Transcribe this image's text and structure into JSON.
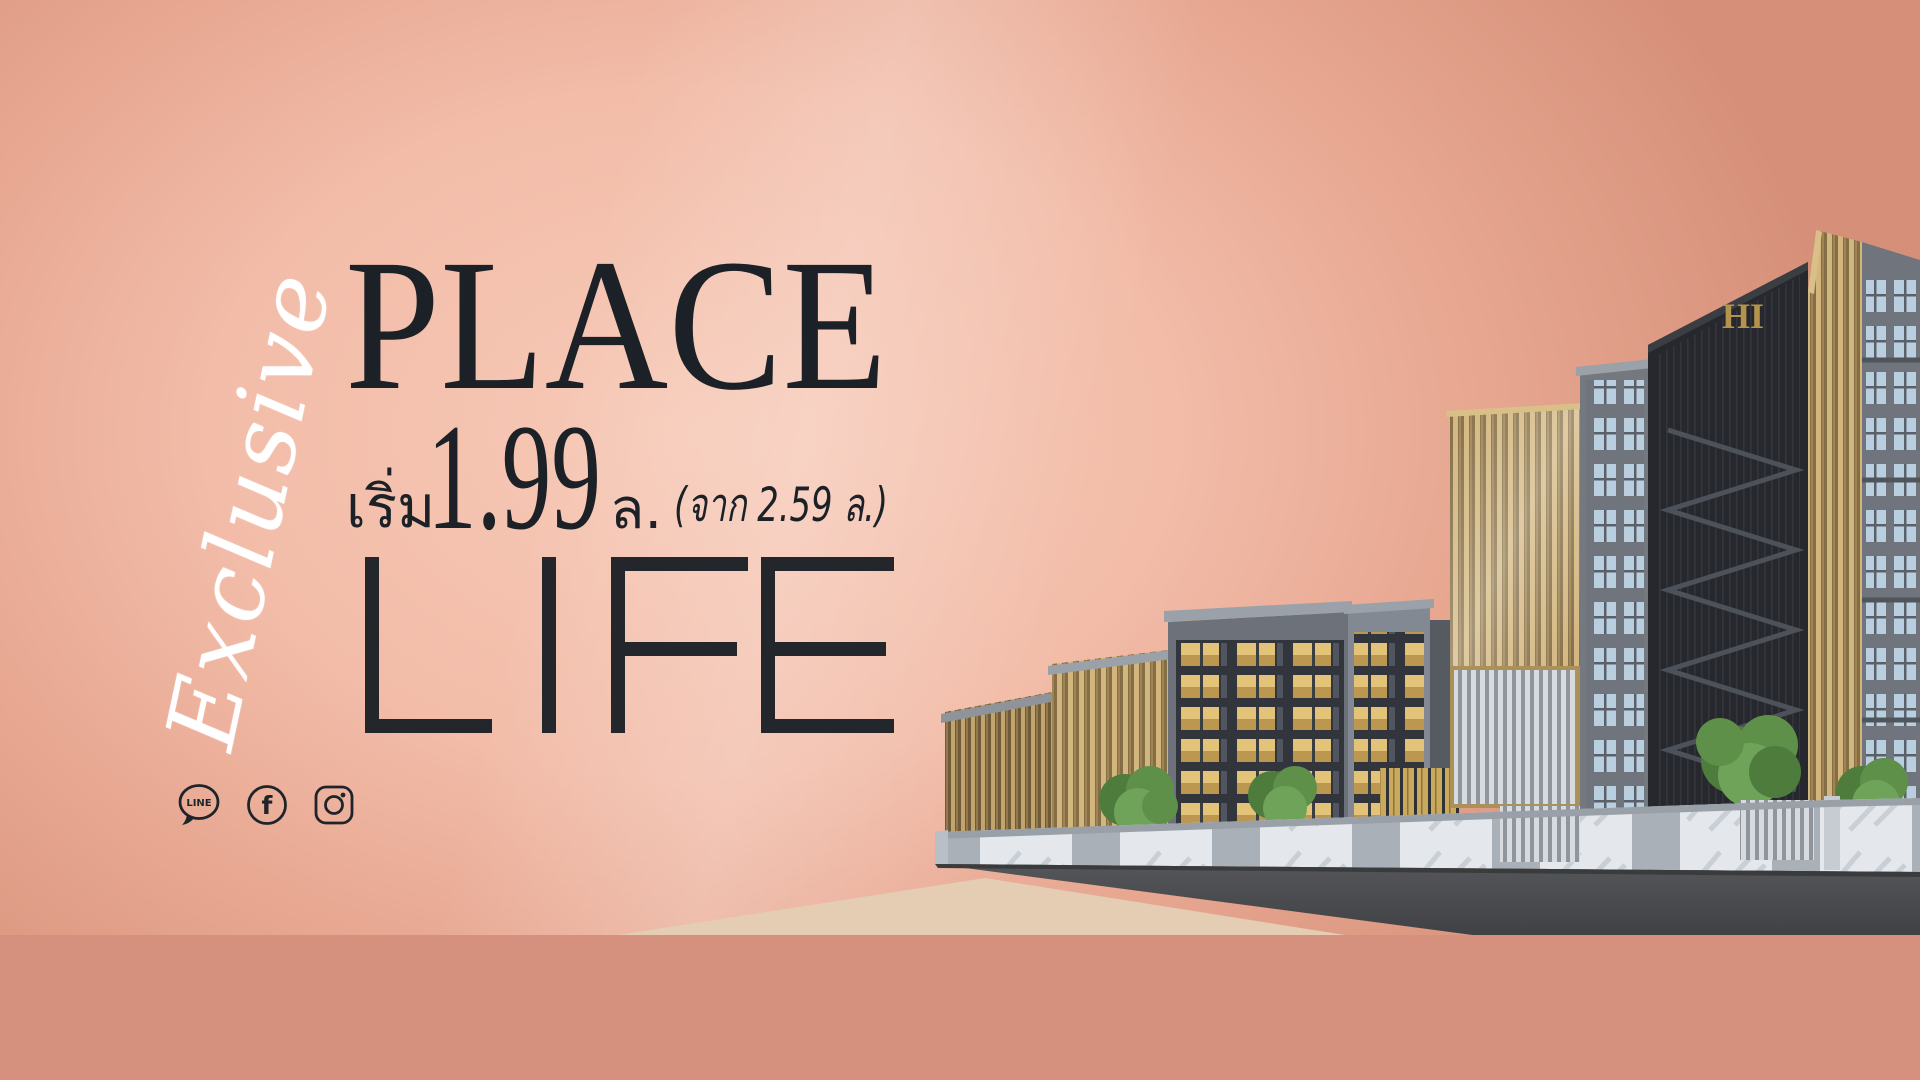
{
  "hero": {
    "script_word": "Exclusive",
    "headline_top": "PLACE",
    "price_prefix": "เริ่ม",
    "price_value": "1.99",
    "price_unit": "ล.",
    "price_note": "(จาก 2.59 ล.)",
    "headline_bottom": "LIFE"
  },
  "social": {
    "line_label": "LINE",
    "facebook_label": "f",
    "items": [
      "line",
      "facebook",
      "instagram"
    ]
  },
  "building": {
    "logo_text": "HI"
  },
  "colors": {
    "text": "#1c2127",
    "script": "#ffffff",
    "bg_light": "#f6c8b5",
    "bg_mid": "#eeb09b",
    "bg_dark": "#cf8a75",
    "bottom_band": "#d5917e",
    "ground": "#e4cdb2",
    "gold": "#c2a46d",
    "facade_dark": "#26282d",
    "facade_gray": "#74797f",
    "marble": "#e4e8ec",
    "platform": "#4a4b4d",
    "tree": "#5f9049",
    "lit_window": "#e2c378",
    "glass_window": "#b9cfdf"
  }
}
